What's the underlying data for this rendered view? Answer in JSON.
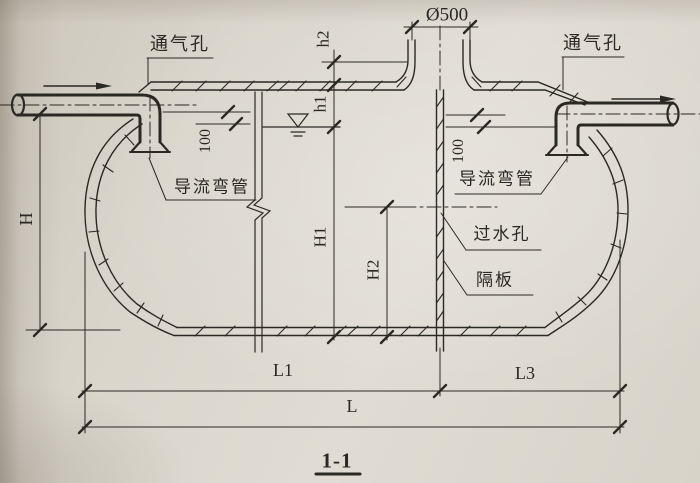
{
  "drawing": {
    "section_title": "1-1",
    "colors": {
      "paper": "#dcd8cf",
      "ink": "#2b2924"
    },
    "labels": {
      "manhole_dia": "Ø500",
      "vent_left": "通气孔",
      "vent_right": "通气孔",
      "elbow_left": "导流弯管",
      "elbow_right": "导流弯管",
      "water_hole": "过水孔",
      "partition": "隔板"
    },
    "dimensions": {
      "h1": "h1",
      "h2": "h2",
      "H": "H",
      "H1": "H1",
      "H2": "H2",
      "d100_left": "100",
      "d100_right": "100",
      "L1": "L1",
      "L3": "L3",
      "L": "L"
    }
  }
}
